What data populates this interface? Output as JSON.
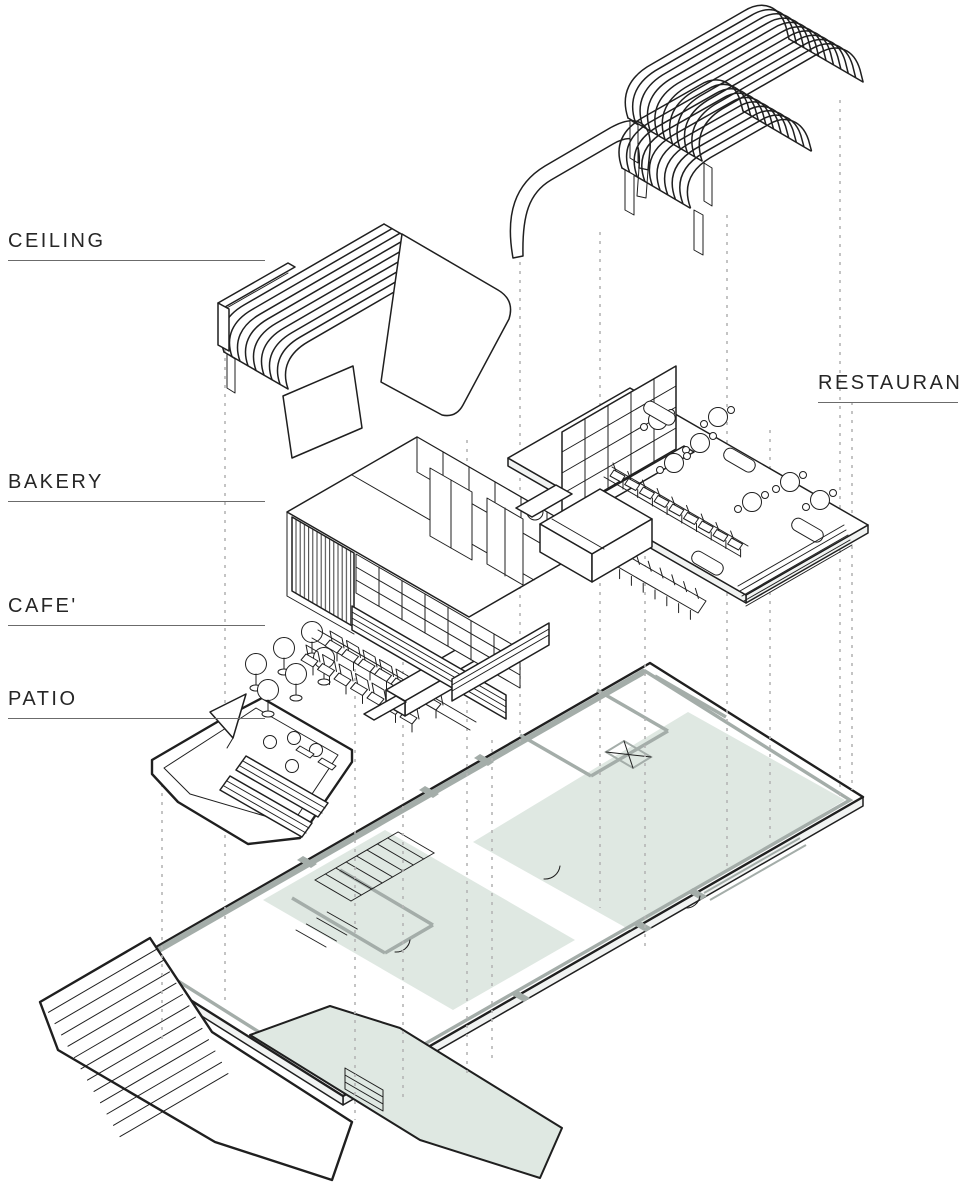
{
  "labels": {
    "ceiling": "CEILING",
    "bakery": "BAKERY",
    "cafe": "CAFE'",
    "patio": "PATIO",
    "restaurant": "RESTAURANT"
  },
  "colors": {
    "line": "#1f1f1f",
    "wall_gray": "#a4ada9",
    "plan_green": "#dfe8e2",
    "dashed_gray": "#b5b5b5",
    "label_text": "#262626",
    "underline_gray": "#6b6b6b",
    "background": "#ffffff"
  }
}
